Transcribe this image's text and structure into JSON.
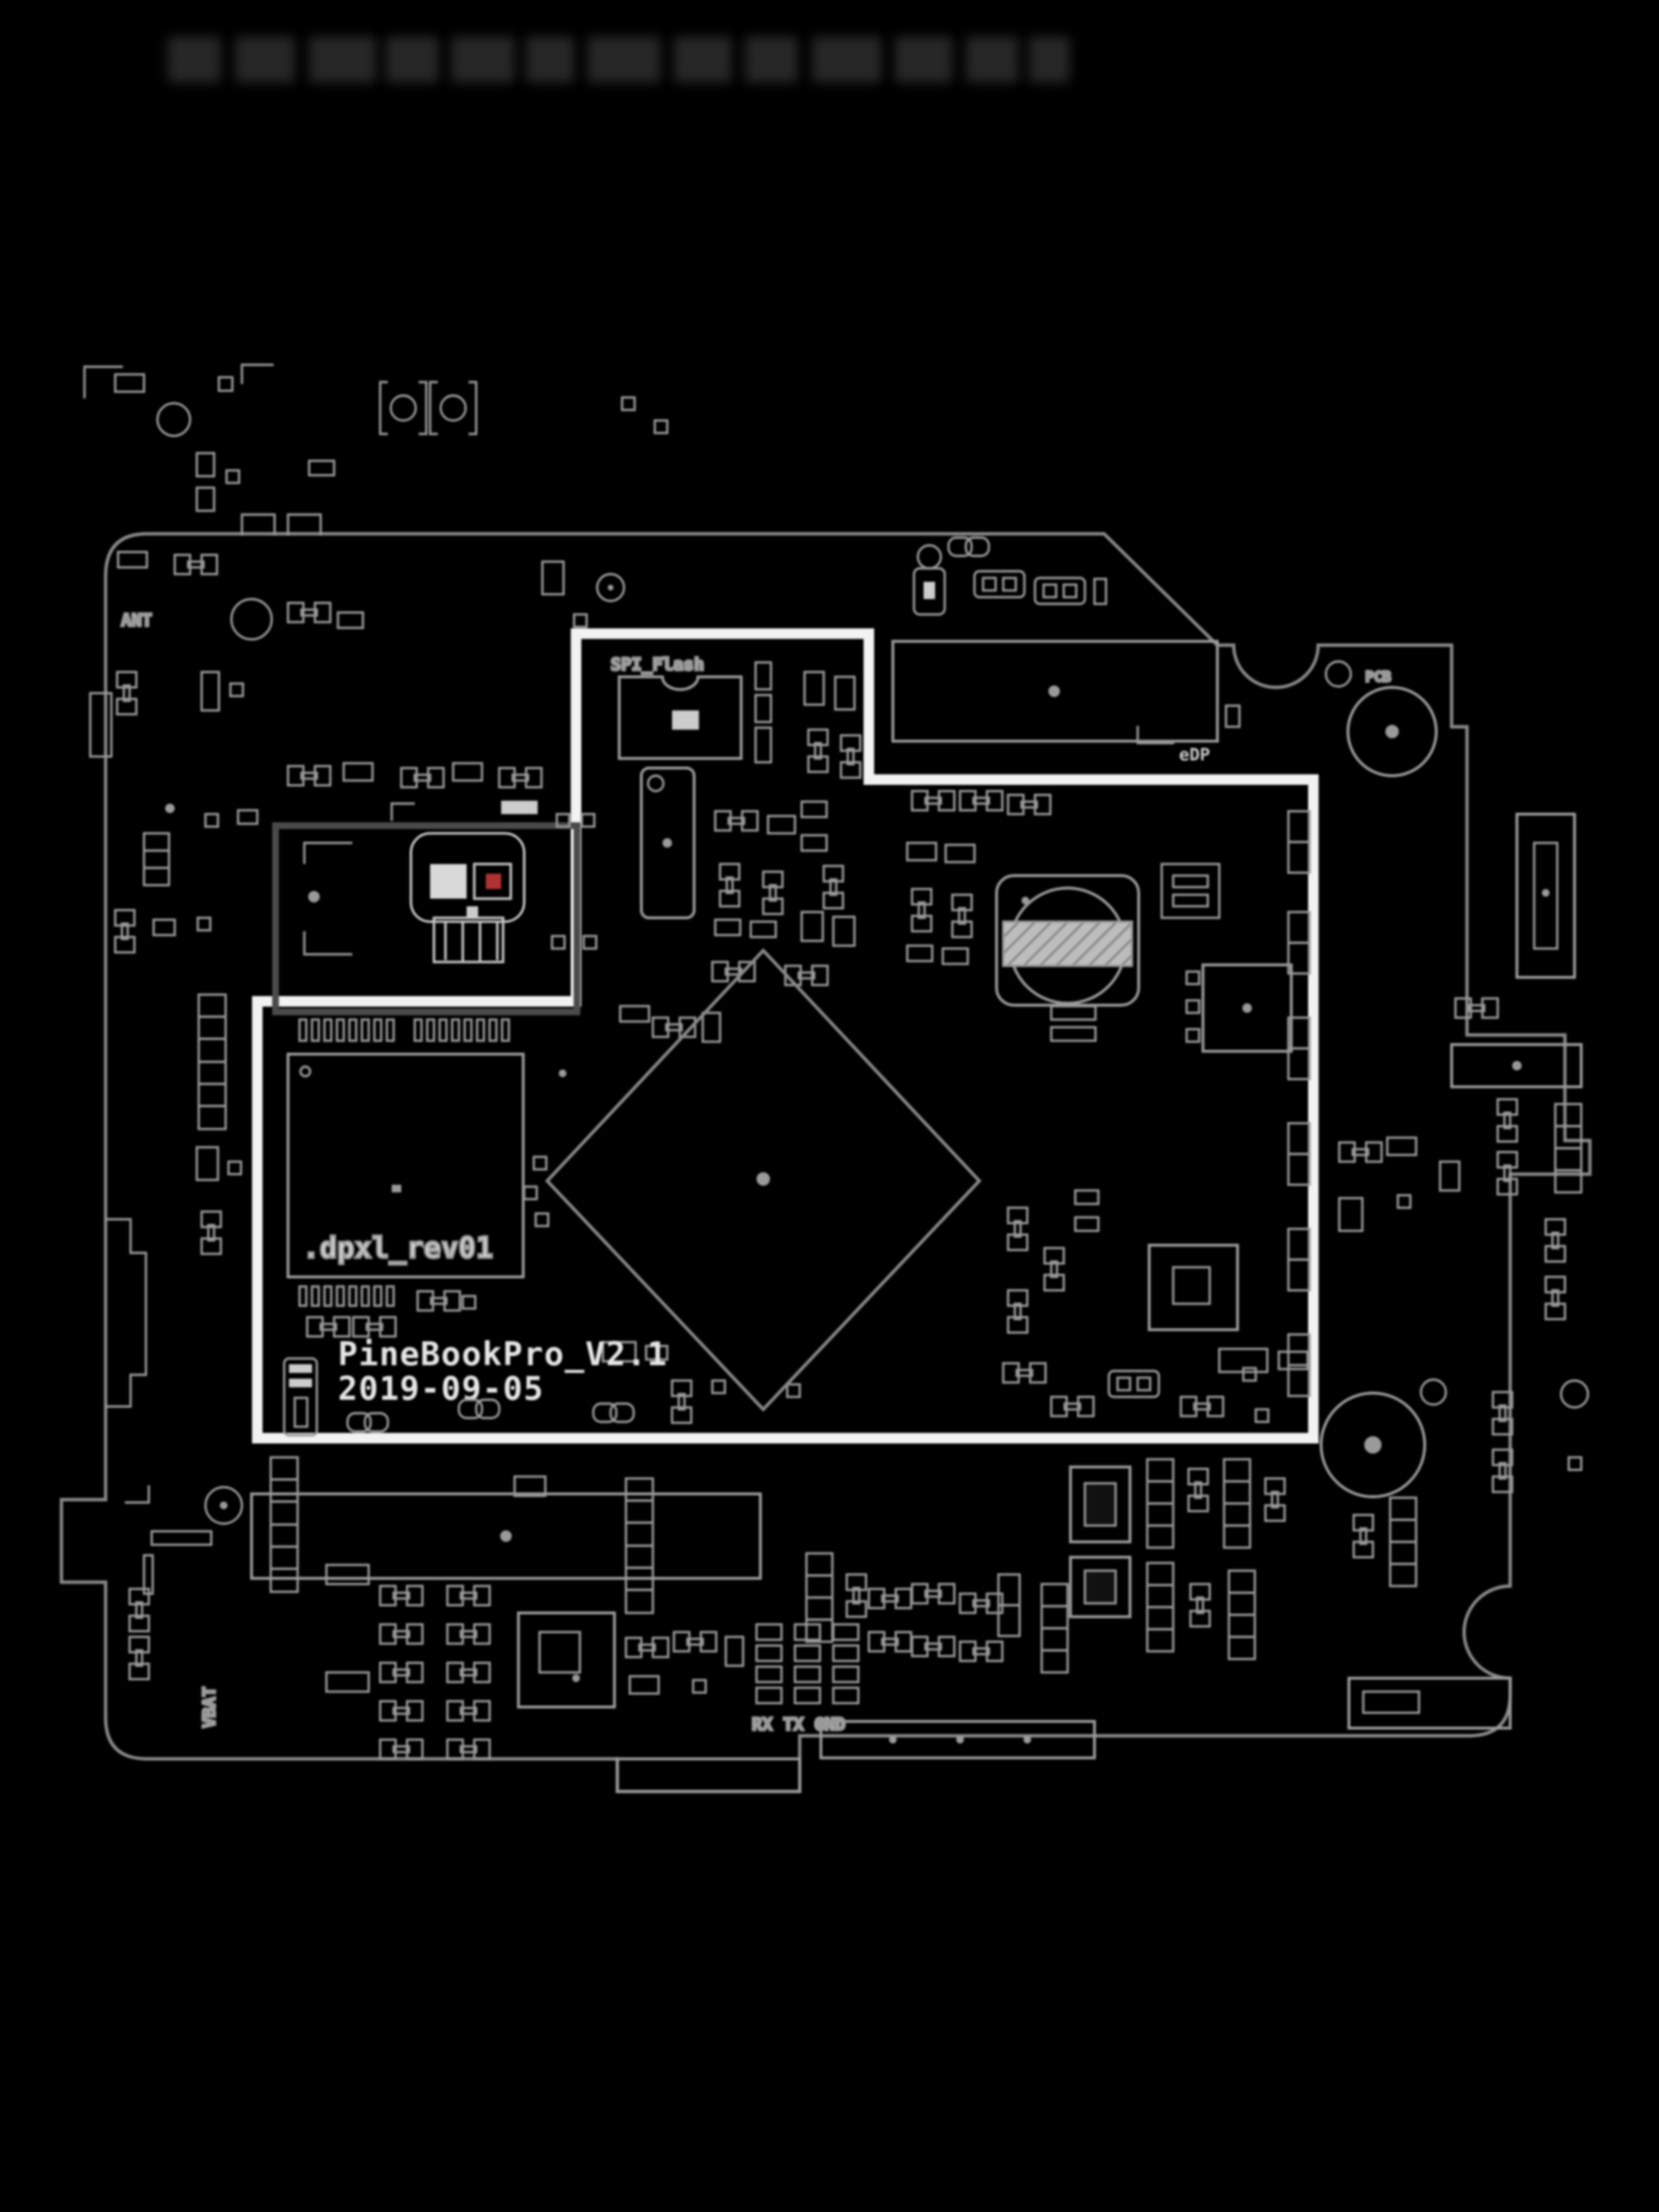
{
  "board": {
    "silkscreen": {
      "title": "PineBookPro_V2.1",
      "date": "2019-09-05",
      "ram_revision": ".dpxl_rev01",
      "spi_flash": "SPI_Flash",
      "uart_header": "RX TX GND",
      "edp_connector": "eDP",
      "pcb_marker": "PCB",
      "antenna": "ANT",
      "battery": "VBAT"
    },
    "colors": {
      "background": "#000000",
      "silkscreen_lines": "#9a9a9a",
      "module_highlight": "#f2f2f2",
      "module_frame": "#4a4a4a",
      "skull_eye_accent": "#b03232"
    },
    "icons": [
      "skull-icon",
      "chain-link-icon",
      "microphone-icon",
      "mounting-hole-icon",
      "screw-bracket-icon",
      "round-component-icon"
    ]
  }
}
